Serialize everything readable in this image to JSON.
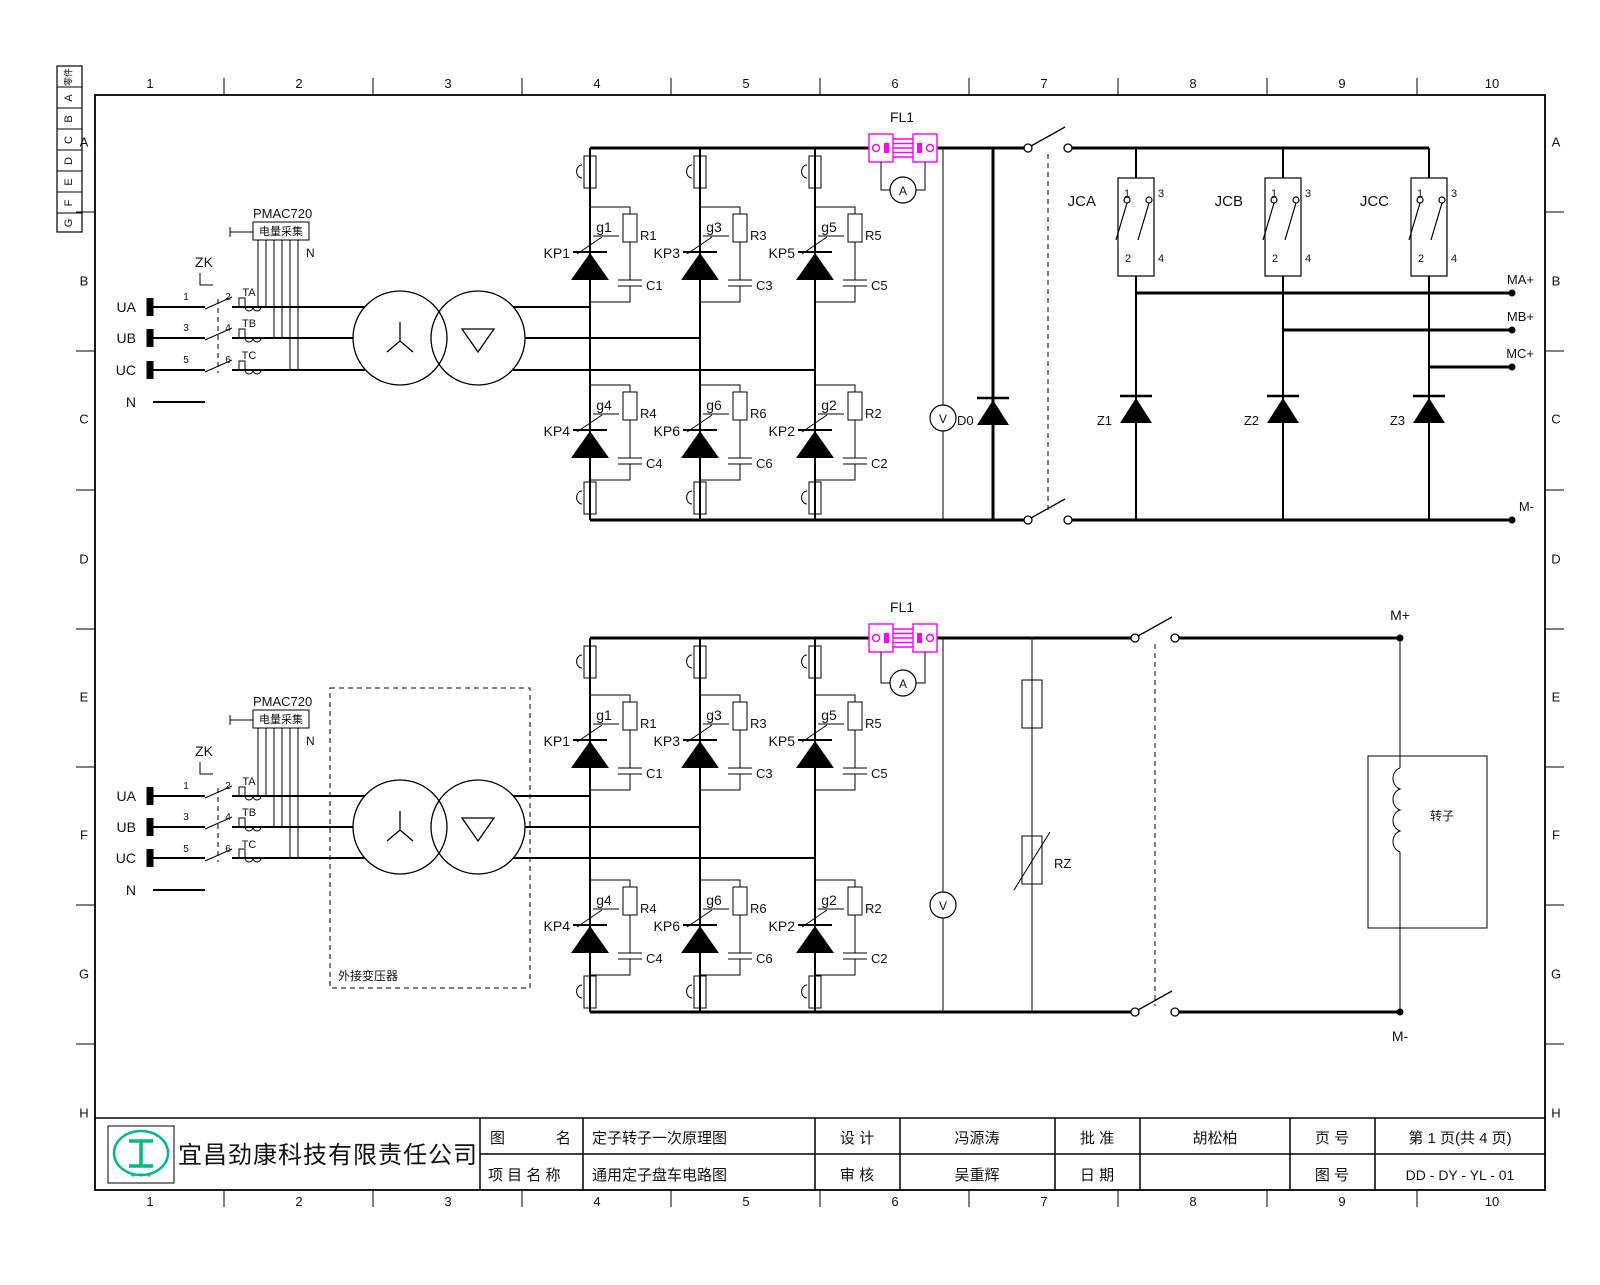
{
  "frame": {
    "cols": [
      "1",
      "2",
      "3",
      "4",
      "5",
      "6",
      "7",
      "8",
      "9",
      "10"
    ],
    "rows": [
      "A",
      "B",
      "C",
      "D",
      "E",
      "F",
      "G",
      "H"
    ],
    "strip": [
      "零件",
      "A",
      "B",
      "C",
      "D",
      "E",
      "F",
      "G"
    ]
  },
  "input": {
    "ua": "UA",
    "ub": "UB",
    "uc": "UC",
    "n": "N",
    "zk": "ZK",
    "ta": "TA",
    "tb": "TB",
    "tc": "TC",
    "p1": "1",
    "p2": "2",
    "p3": "3",
    "p4": "4",
    "p5": "5",
    "p6": "6"
  },
  "pmac": {
    "model": "PMAC720",
    "name": "电量采集",
    "n": "N"
  },
  "bridge": {
    "kp1": "KP1",
    "kp2": "KP2",
    "kp3": "KP3",
    "kp4": "KP4",
    "kp5": "KP5",
    "kp6": "KP6",
    "g1": "g1",
    "g2": "g2",
    "g3": "g3",
    "g4": "g4",
    "g5": "g5",
    "g6": "g6",
    "r1": "R1",
    "r2": "R2",
    "r3": "R3",
    "r4": "R4",
    "r5": "R5",
    "r6": "R6",
    "c1": "C1",
    "c2": "C2",
    "c3": "C3",
    "c4": "C4",
    "c5": "C5",
    "c6": "C6"
  },
  "dc": {
    "fl1": "FL1",
    "ammeter": "A",
    "voltmeter": "V",
    "d0": "D0",
    "rz": "RZ"
  },
  "contactors": {
    "jca": "JCA",
    "jcb": "JCB",
    "jcc": "JCC",
    "p1": "1",
    "p2": "2",
    "p3": "3",
    "p4": "4"
  },
  "zdiodes": {
    "z1": "Z1",
    "z2": "Z2",
    "z3": "Z3"
  },
  "outputs": {
    "ma": "MA+",
    "mb": "MB+",
    "mc": "MC+",
    "mminus": "M-",
    "mplus": "M+"
  },
  "rotor": {
    "label": "转子",
    "ext_transformer": "外接变压器"
  },
  "titleblock": {
    "company": "宜昌劲康科技有限责任公司",
    "drawing_label_l": "图",
    "drawing_label_r": "名",
    "drawing_name": "定子转子一次原理图",
    "project_label": "项 目 名 称",
    "project_name": "通用定子盘车电路图",
    "design_label": "设  计",
    "designer": "冯源涛",
    "check_label": "审  核",
    "checker": "吴重辉",
    "approve_label": "批 准",
    "approver": "胡松柏",
    "date_label": "日 期",
    "date_value": "",
    "page_label": "页 号",
    "page_value": "第 1 页(共 4 页)",
    "dwgno_label": "图 号",
    "dwgno_value": "DD - DY - YL - 01"
  },
  "colors": {
    "accent": "#FF00FF",
    "logo": "#00B884"
  }
}
